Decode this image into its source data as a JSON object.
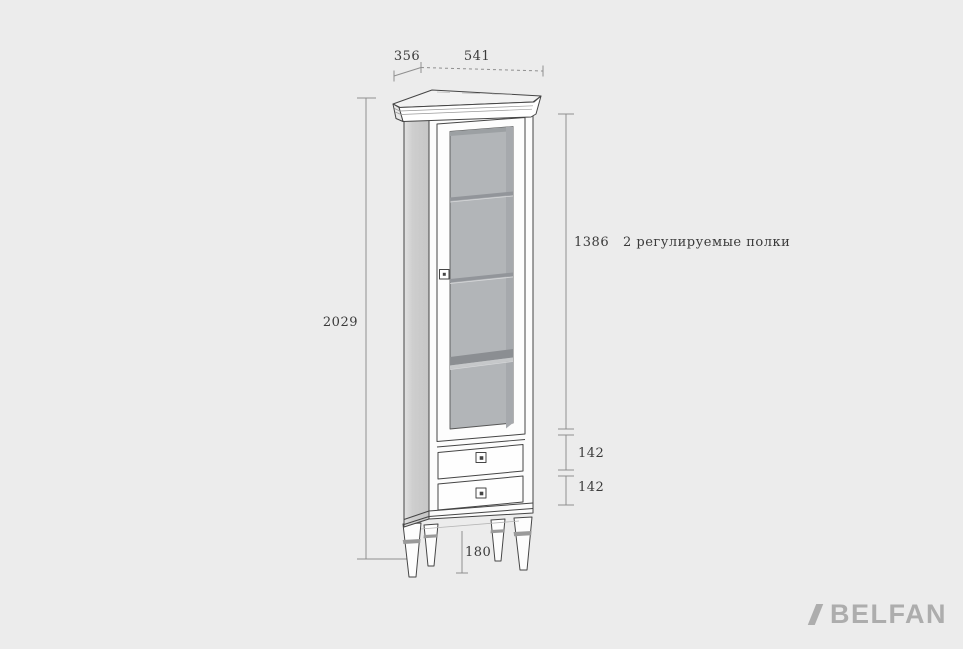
{
  "drawing": {
    "kind": "furniture technical drawing, single-door display cabinet (vitrine)",
    "dimensions": {
      "depth": "356",
      "width": "541",
      "total_height": "2029",
      "glass_section": "1386",
      "upper_drawer": "142",
      "lower_drawer": "142",
      "legs": "180"
    },
    "note": "2 регулируемые полки"
  },
  "brand": {
    "name": "BELFAN"
  },
  "colors": {
    "background": "#ececec",
    "outline": "#454545",
    "dimension_line": "#8f8f8f",
    "label_text": "#3a3a3a",
    "glass": "#b2b5b8",
    "side_panel": "#cdcdcd",
    "cabinet_front": "#fcfcfc",
    "brand_gray": "#adadad"
  }
}
